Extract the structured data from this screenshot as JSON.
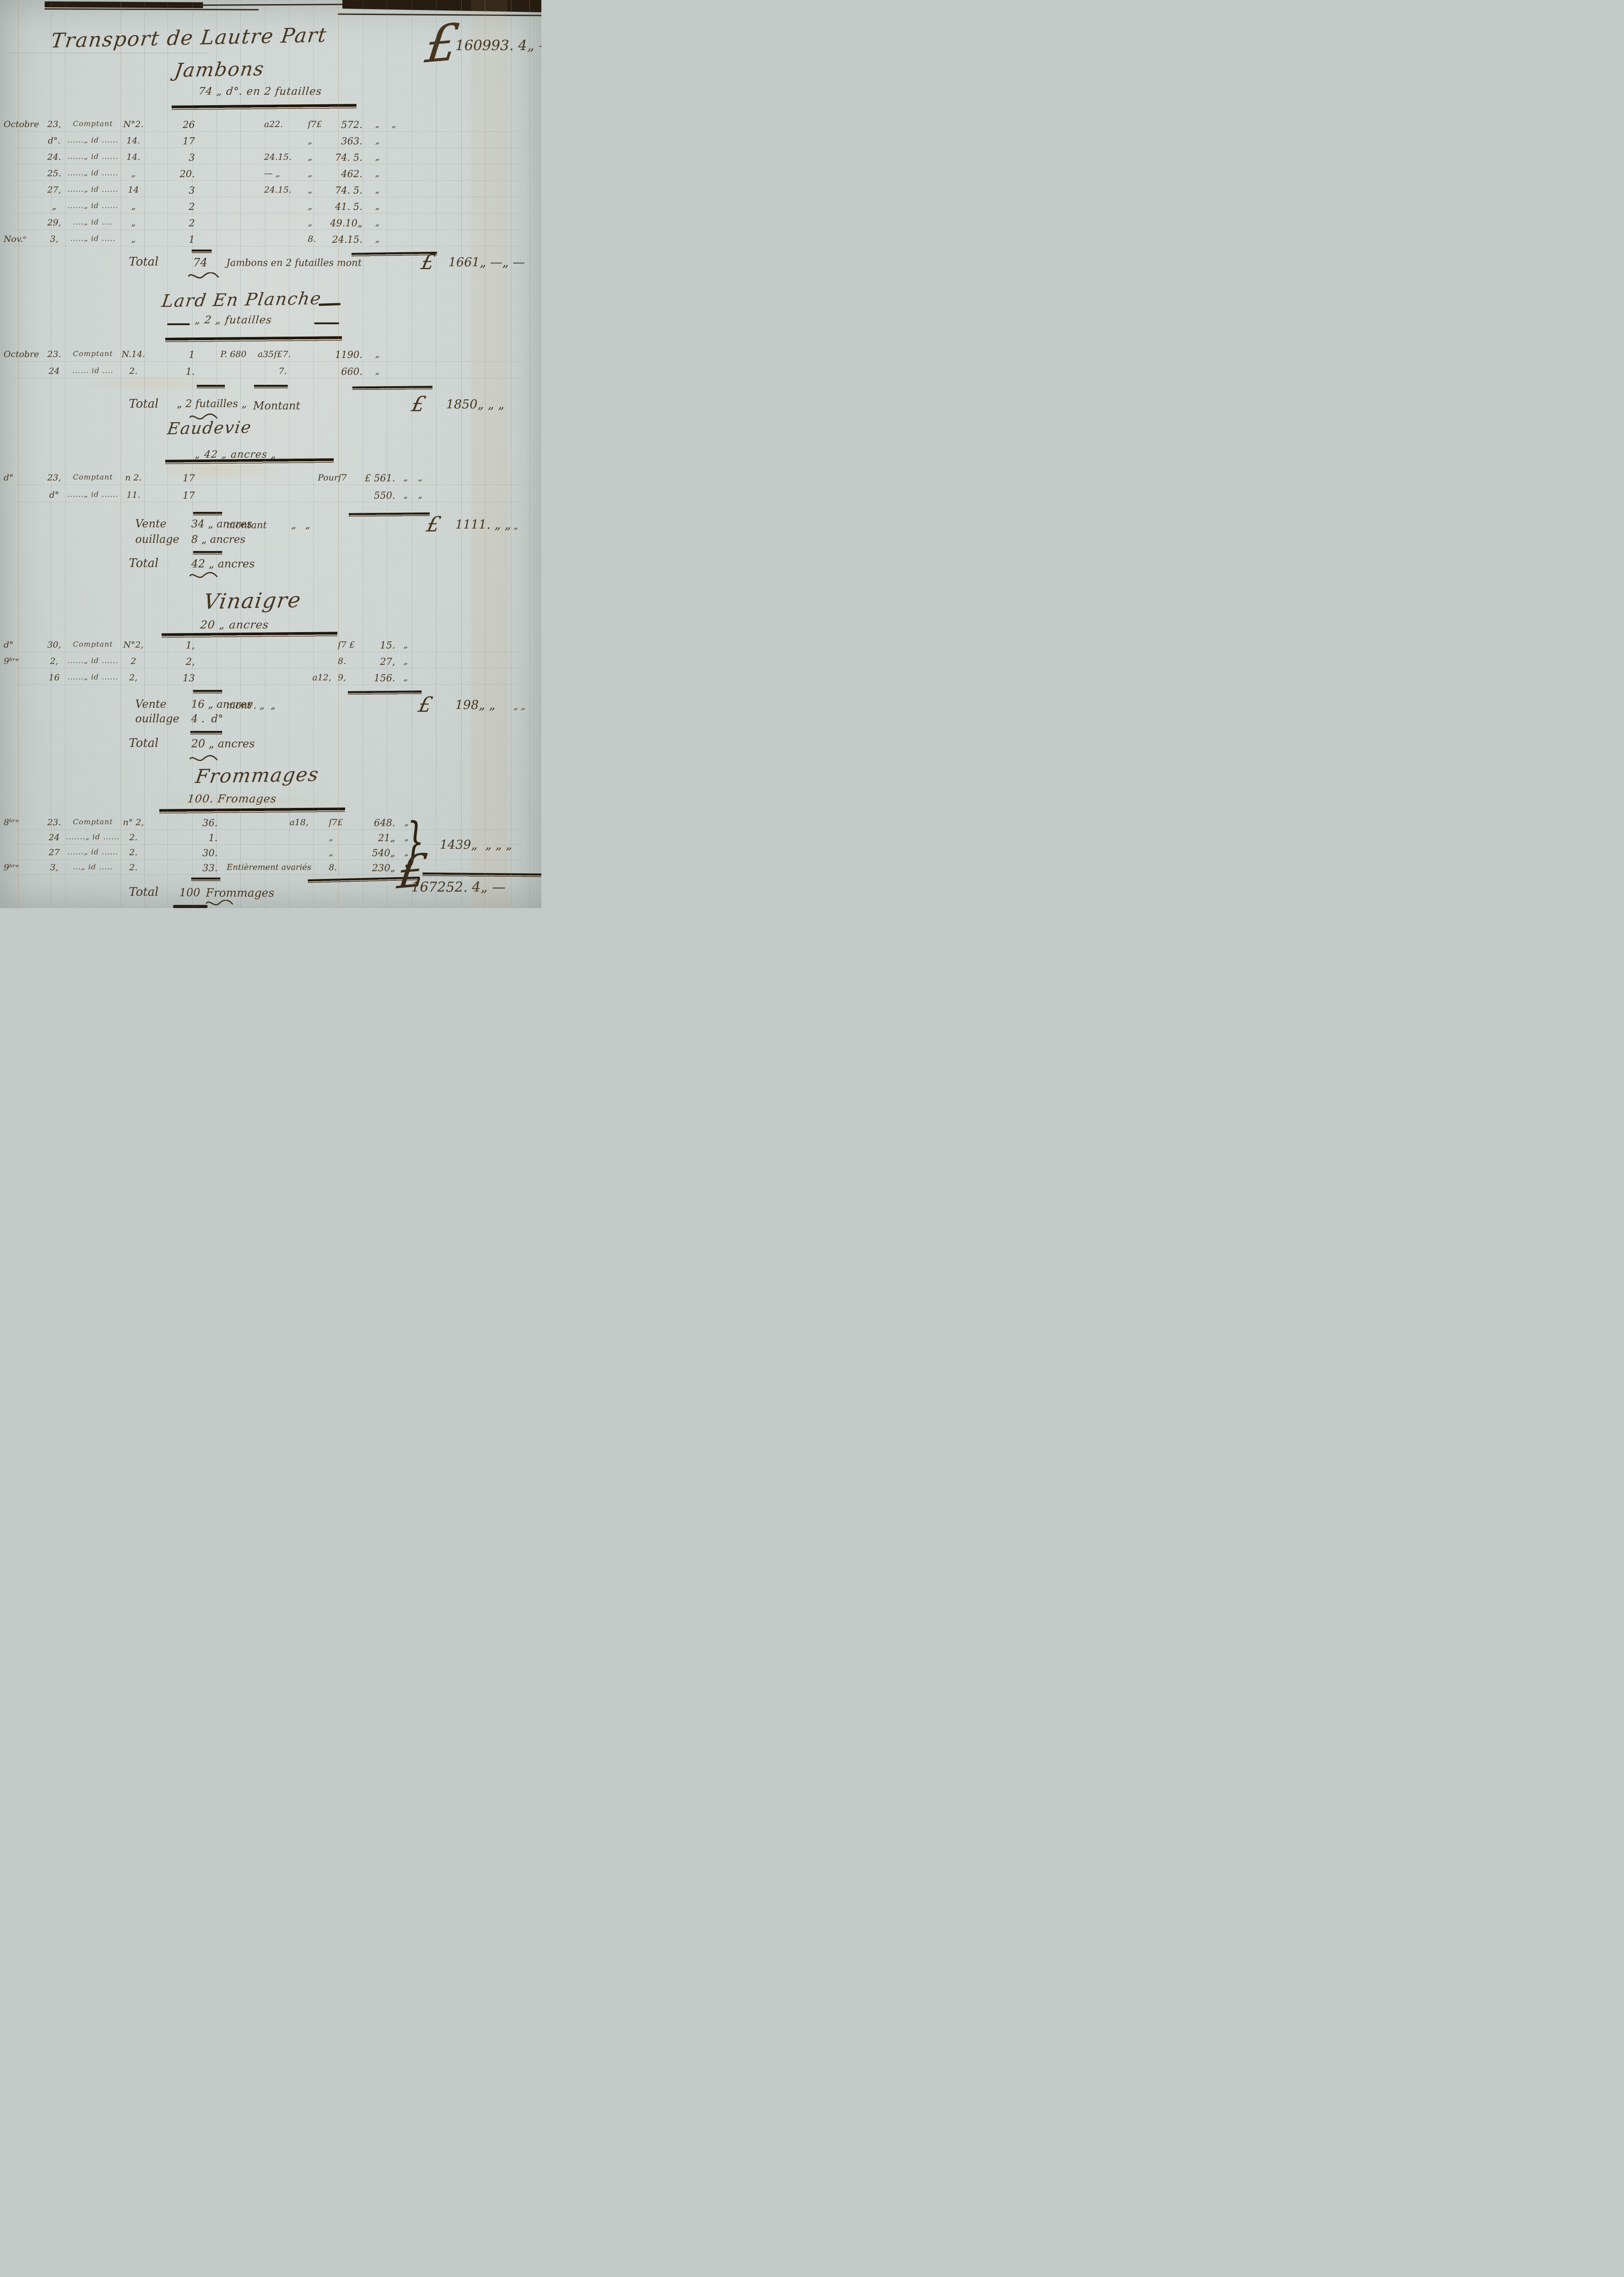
{
  "colors": {
    "paper": "#cdd4d1",
    "ink": "#46351f",
    "rule_dark": "#241a0e"
  },
  "header": {
    "title": "Transport de Lautre Part",
    "currency": "£",
    "amount": "160993. 4„ —"
  },
  "sections": [
    {
      "id": "jambons",
      "title": "Jambons",
      "subtitle": "74 „ d°. en 2 futailles",
      "rows": [
        {
          "date": "Octobre",
          "day": "23,",
          "desc": "Comptant",
          "num": "N°2.",
          "qty": "26",
          "price": "a22.",
          "sous": "ſ7£",
          "amt": "572.",
          "d1": "„",
          "d2": "„"
        },
        {
          "day": "d°.",
          "desc": "......„ id ......",
          "num": "14.",
          "qty": "17",
          "sous": "„",
          "amt": "363.",
          "d1": "„"
        },
        {
          "day": "24.",
          "desc": "......„ id ......",
          "num": "14.",
          "qty": "3",
          "price": "24.15.",
          "sous": "„",
          "amt": "74. 5.",
          "d1": "„"
        },
        {
          "day": "25.",
          "desc": "......„ id ......",
          "num": "„",
          "qty": "20.",
          "price": "— „",
          "sous": "„",
          "amt": "462.",
          "d1": "„"
        },
        {
          "day": "27,",
          "desc": "......„ id ......",
          "num": "14",
          "qty": "3",
          "price": "24.15.",
          "sous": "„",
          "amt": "74. 5.",
          "d1": "„"
        },
        {
          "day": "„",
          "desc": "......„ id ......",
          "num": "„",
          "qty": "2",
          "sous": "„",
          "amt": "41. 5.",
          "d1": "„"
        },
        {
          "day": "29,",
          "desc": "....„ id ....",
          "num": "„",
          "qty": "2",
          "sous": "„",
          "amt": "49.10„",
          "d1": "„"
        },
        {
          "date": "Nov.ᵉ",
          "day": "3,",
          "desc": ".....„ id .....",
          "num": "„",
          "qty": "1",
          "sous": "8.",
          "amt": "24.15.",
          "d1": "„"
        }
      ],
      "total": {
        "label": "Total",
        "qty": "74",
        "text": "Jambons en 2 futailles mont",
        "currency": "£",
        "value": "1661„ —„ —"
      }
    },
    {
      "id": "lard",
      "title": "Lard En Planche",
      "subtitle": "„ 2 „ futailles",
      "rows": [
        {
          "date": "Octobre",
          "day": "23.",
          "desc": "Comptant",
          "num": "N.14.",
          "qty": "1",
          "note": "P. 680",
          "price": "a35ſ£7.",
          "amt": "1190.",
          "d1": "„"
        },
        {
          "day": "24",
          "desc": "...... id ....",
          "num": "2.",
          "qty": "1.",
          "sous": "7.",
          "amt": "660.",
          "d1": "„"
        }
      ],
      "total": {
        "label": "Total",
        "qty": "„ 2 futailles „",
        "text": "Montant",
        "currency": "£",
        "value": "1850„ „ „"
      }
    },
    {
      "id": "eaudevie",
      "title": "Eaudevie",
      "subtitle": "„ 42 „ ancres „",
      "rows": [
        {
          "date": "d°",
          "day": "23,",
          "desc": "Comptant",
          "num": "n 2.",
          "qty": "17",
          "sous": "Pourſ7",
          "amt": "£ 561.",
          "d1": "„",
          "d2": "„"
        },
        {
          "day": "d°",
          "desc": "......„ id ......",
          "num": "11.",
          "qty": "17",
          "amt": "550.",
          "d1": "„",
          "d2": "„"
        }
      ],
      "vente": {
        "label": "Vente",
        "qty": "34 „ ancres",
        "text": "montant        „   „",
        "currency": "£",
        "value": "1111. „ „",
        "tail": "„"
      },
      "ouillage": {
        "label": "ouillage",
        "qty": "8 „ ancres"
      },
      "total": {
        "label": "Total",
        "qty": "42 „ ancres"
      }
    },
    {
      "id": "vinaigre",
      "title": "Vinaigre",
      "subtitle": "20 „ ancres",
      "rows": [
        {
          "date": "d°",
          "day": "30,",
          "desc": "Comptant",
          "num": "N°2,",
          "qty": "1,",
          "sous": "ſ7 £",
          "amt": "15.",
          "d1": "„"
        },
        {
          "date": "9ᵇʳᵉ",
          "day": "2,",
          "desc": "......„ id ......",
          "num": "2",
          "qty": "2,",
          "sous": "8.",
          "amt": "27,",
          "d1": "„"
        },
        {
          "day": "16",
          "desc": "......„ id ......",
          "num": "2,",
          "qty": "13",
          "price": "a12,",
          "sous": "9,",
          "amt": "156.",
          "d1": "„"
        }
      ],
      "vente": {
        "label": "Vente",
        "qty": "16 „ ancres",
        "text": "montᵗ. „  „",
        "currency": "£",
        "value": "198„ „",
        "tail": "„ „"
      },
      "ouillage": {
        "label": "ouillage",
        "qty": "4 .  d°"
      },
      "total": {
        "label": "Total",
        "qty": "20 „ ancres"
      }
    },
    {
      "id": "frommages",
      "title": "Frommages",
      "subtitle": "100. Fromages",
      "rows": [
        {
          "date": "8ᵇʳᵉ",
          "day": "23.",
          "desc": "Comptant",
          "num": "n° 2,",
          "qty": "36.",
          "price": "a18,",
          "sous": "ſ7£",
          "amt": "648.",
          "d1": "„"
        },
        {
          "day": "24",
          "desc": ".......„ id ......",
          "num": "2.",
          "qty": "1.",
          "sous": "„",
          "amt": "21„",
          "d1": "„"
        },
        {
          "day": "27",
          "desc": "......„ id ......",
          "num": "2.",
          "qty": "30.",
          "sous": "„",
          "amt": "540„",
          "d1": "„"
        },
        {
          "date": "9ᵇʳᵉ",
          "day": "3,",
          "desc": "...„ id .....",
          "num": "2.",
          "qty": "33.",
          "note": "Entièrement avariés",
          "sous": "8.",
          "amt": "230„",
          "d1": "„"
        }
      ],
      "brace": "}",
      "group_total": "1439„  „ „ „",
      "total": {
        "label": "Total",
        "qty": "100",
        "text": "Frommages"
      }
    }
  ],
  "grand_total": {
    "currency": "£",
    "value": "167252. 4„ —"
  }
}
